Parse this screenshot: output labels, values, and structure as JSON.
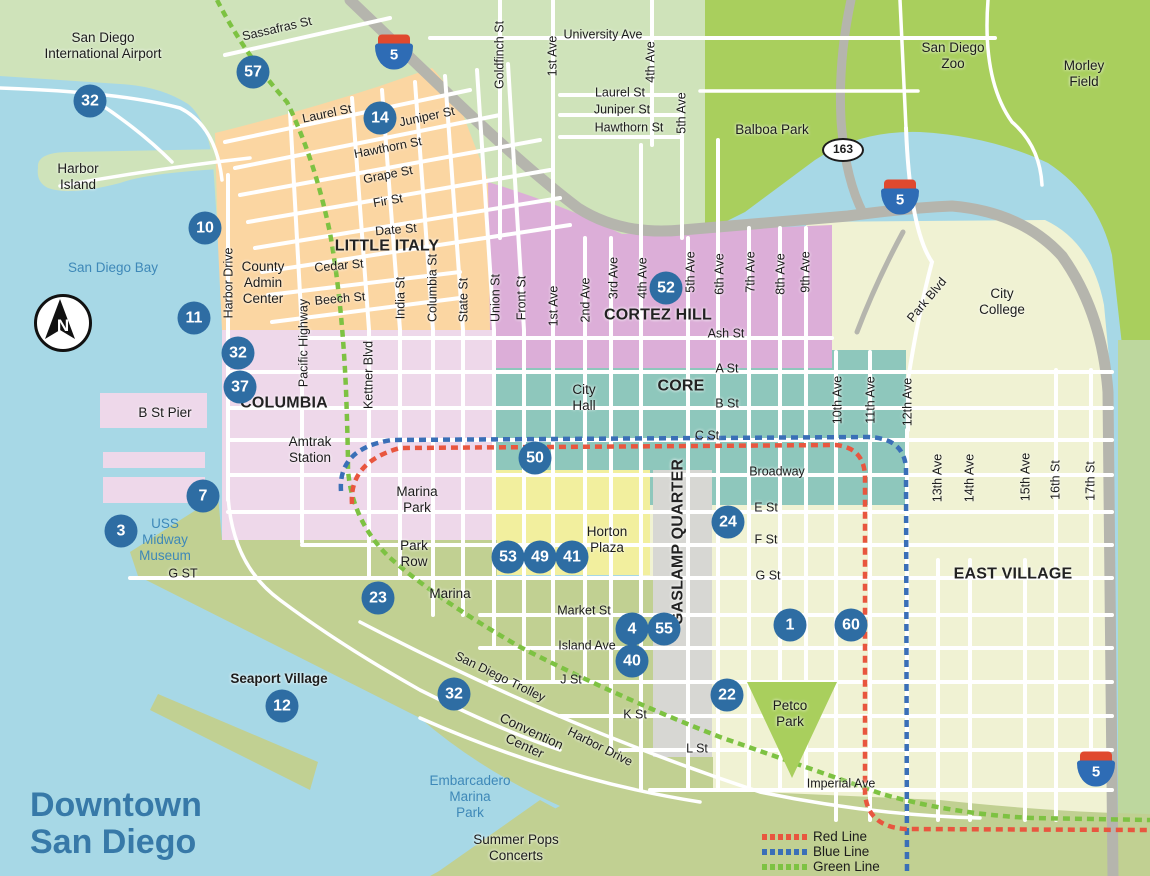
{
  "title": "Downtown\nSan Diego",
  "compass": {
    "label": "N"
  },
  "legend": [
    {
      "label": "Red Line",
      "color": "#e8563f"
    },
    {
      "label": "Blue Line",
      "color": "#3a6fb7"
    },
    {
      "label": "Green Line",
      "color": "#7dc242"
    }
  ],
  "colors": {
    "water": "#a7d8e6",
    "landPale": "#cfe3ba",
    "landBright": "#a9cf5d",
    "landMid": "#bdd79e",
    "olive": "#c1d092",
    "orange": "#fbd6a2",
    "cortez": "#dcaed8",
    "pinkLight": "#eed8ea",
    "teal": "#8ec7bc",
    "eastVillage": "#f0f2d3",
    "yellow": "#f2ef9e",
    "gray": "#d7d7d3",
    "freeway": "#b5b5ad",
    "marker": "#2e6da3",
    "redLine": "#e8563f",
    "blueLine": "#3a6fb7",
    "greenLine": "#7dc242",
    "waterText": "#3e88b8",
    "titleText": "#3779a8"
  },
  "shields": [
    {
      "k": "i",
      "t": "5",
      "x": 394,
      "y": 52
    },
    {
      "k": "i",
      "t": "5",
      "x": 900,
      "y": 197
    },
    {
      "k": "i",
      "t": "5",
      "x": 1096,
      "y": 769
    },
    {
      "k": "s",
      "t": "163",
      "x": 843,
      "y": 150
    }
  ],
  "markers": [
    {
      "n": "57",
      "x": 253,
      "y": 72
    },
    {
      "n": "32",
      "x": 90,
      "y": 101
    },
    {
      "n": "14",
      "x": 380,
      "y": 118
    },
    {
      "n": "10",
      "x": 205,
      "y": 228
    },
    {
      "n": "11",
      "x": 194,
      "y": 318
    },
    {
      "n": "32",
      "x": 238,
      "y": 353
    },
    {
      "n": "37",
      "x": 240,
      "y": 387
    },
    {
      "n": "52",
      "x": 666,
      "y": 288
    },
    {
      "n": "50",
      "x": 535,
      "y": 458
    },
    {
      "n": "7",
      "x": 203,
      "y": 496
    },
    {
      "n": "3",
      "x": 121,
      "y": 531
    },
    {
      "n": "53",
      "x": 508,
      "y": 557
    },
    {
      "n": "49",
      "x": 540,
      "y": 557
    },
    {
      "n": "41",
      "x": 572,
      "y": 557
    },
    {
      "n": "24",
      "x": 728,
      "y": 522
    },
    {
      "n": "23",
      "x": 378,
      "y": 598
    },
    {
      "n": "4",
      "x": 632,
      "y": 629
    },
    {
      "n": "55",
      "x": 664,
      "y": 629
    },
    {
      "n": "40",
      "x": 632,
      "y": 661
    },
    {
      "n": "1",
      "x": 790,
      "y": 625
    },
    {
      "n": "60",
      "x": 851,
      "y": 625
    },
    {
      "n": "22",
      "x": 727,
      "y": 695
    },
    {
      "n": "12",
      "x": 282,
      "y": 706
    },
    {
      "n": "32",
      "x": 454,
      "y": 694
    }
  ],
  "labels": [
    [
      "San Diego\nInternational Airport",
      103,
      46,
      "pl"
    ],
    [
      "Harbor\nIsland",
      78,
      177,
      "pl"
    ],
    [
      "San Diego Bay",
      113,
      268,
      "water"
    ],
    [
      "Sassafras St",
      277,
      29,
      "st",
      -13
    ],
    [
      "University Ave",
      603,
      35,
      "st"
    ],
    [
      "Goldfinch St",
      500,
      55,
      "st",
      -90
    ],
    [
      "1st Ave",
      553,
      56,
      "st",
      -90
    ],
    [
      "4th Ave",
      651,
      62,
      "st",
      -90
    ],
    [
      "5th Ave",
      682,
      113,
      "st",
      -90
    ],
    [
      "Laurel St",
      620,
      93,
      "st"
    ],
    [
      "Juniper St",
      622,
      110,
      "st"
    ],
    [
      "Hawthorn St",
      629,
      128,
      "st"
    ],
    [
      "Balboa Park",
      772,
      130,
      "pl"
    ],
    [
      "San Diego\nZoo",
      953,
      56,
      "pl"
    ],
    [
      "Morley\nField",
      1084,
      74,
      "pl"
    ],
    [
      "City\nCollege",
      1002,
      302,
      "pl"
    ],
    [
      "Park Blvd",
      927,
      300,
      "st",
      -50
    ],
    [
      "Laurel St",
      327,
      114,
      "st",
      -12
    ],
    [
      "Juniper St",
      427,
      117,
      "st",
      -12
    ],
    [
      "Hawthorn St",
      388,
      148,
      "st",
      -11
    ],
    [
      "Grape St",
      388,
      175,
      "st",
      -11
    ],
    [
      "Fir St",
      388,
      201,
      "st",
      -10
    ],
    [
      "Date St",
      396,
      230,
      "st",
      -5
    ],
    [
      "LITTLE ITALY",
      387,
      247,
      "area"
    ],
    [
      "Cedar St",
      339,
      266,
      "st",
      -5
    ],
    [
      "Beech St",
      340,
      299,
      "st",
      -5
    ],
    [
      "Harbor Drive",
      229,
      283,
      "st",
      -90
    ],
    [
      "County\nAdmin\nCenter",
      263,
      283,
      "pl"
    ],
    [
      "Pacific Highway",
      304,
      343,
      "st",
      -90
    ],
    [
      "Kettner Blvd",
      369,
      375,
      "st",
      -90
    ],
    [
      "India St",
      401,
      298,
      "st",
      -90
    ],
    [
      "Columbia St",
      433,
      288,
      "st",
      -90
    ],
    [
      "State St",
      464,
      300,
      "st",
      -90
    ],
    [
      "Union St",
      496,
      298,
      "st",
      -90
    ],
    [
      "Front St",
      522,
      298,
      "st",
      -90
    ],
    [
      "1st Ave",
      554,
      306,
      "st",
      -90
    ],
    [
      "2nd Ave",
      586,
      300,
      "st",
      -90
    ],
    [
      "3rd Ave",
      614,
      278,
      "st",
      -90
    ],
    [
      "4th Ave",
      643,
      278,
      "st",
      -90
    ],
    [
      "5th Ave",
      691,
      272,
      "st",
      -90
    ],
    [
      "6th Ave",
      720,
      274,
      "st",
      -90
    ],
    [
      "7th Ave",
      751,
      272,
      "st",
      -90
    ],
    [
      "8th Ave",
      781,
      274,
      "st",
      -90
    ],
    [
      "9th Ave",
      806,
      272,
      "st",
      -90
    ],
    [
      "10th Ave",
      838,
      400,
      "st",
      -90
    ],
    [
      "11th Ave",
      871,
      400,
      "st",
      -90
    ],
    [
      "12th Ave",
      908,
      402,
      "st",
      -90
    ],
    [
      "13th Ave",
      938,
      478,
      "st",
      -90
    ],
    [
      "14th Ave",
      970,
      478,
      "st",
      -90
    ],
    [
      "15th Ave",
      1026,
      477,
      "st",
      -90
    ],
    [
      "16th St",
      1056,
      480,
      "st",
      -90
    ],
    [
      "17th St",
      1091,
      481,
      "st",
      -90
    ],
    [
      "CORTEZ HILL",
      658,
      316,
      "area"
    ],
    [
      "Ash St",
      726,
      334,
      "st"
    ],
    [
      "A St",
      727,
      369,
      "st"
    ],
    [
      "CORE",
      681,
      387,
      "area"
    ],
    [
      "B St",
      727,
      404,
      "st"
    ],
    [
      "C St",
      707,
      436,
      "st"
    ],
    [
      "City\nHall",
      584,
      398,
      "pl"
    ],
    [
      "COLUMBIA",
      284,
      404,
      "area"
    ],
    [
      "B St Pier",
      165,
      413,
      "pl"
    ],
    [
      "Amtrak\nStation",
      310,
      450,
      "pl"
    ],
    [
      "Broadway",
      777,
      472,
      "st"
    ],
    [
      "Marina\nPark",
      417,
      500,
      "pl"
    ],
    [
      "E St",
      766,
      508,
      "st"
    ],
    [
      "F St",
      766,
      540,
      "st"
    ],
    [
      "Horton\nPlaza",
      607,
      540,
      "pl"
    ],
    [
      "GASLAMP QUARTER",
      679,
      542,
      "area",
      -90
    ],
    [
      "G St",
      768,
      576,
      "st"
    ],
    [
      "EAST VILLAGE",
      1013,
      575,
      "area"
    ],
    [
      "Park\nRow",
      414,
      554,
      "pl"
    ],
    [
      "G ST",
      183,
      574,
      "st"
    ],
    [
      "USS\nMidway\nMuseum",
      165,
      540,
      "water"
    ],
    [
      "Marina",
      450,
      594,
      "pl"
    ],
    [
      "Market St",
      584,
      611,
      "st"
    ],
    [
      "Island Ave",
      587,
      646,
      "st"
    ],
    [
      "J St",
      571,
      680,
      "st"
    ],
    [
      "Seaport Village",
      279,
      679,
      "bold"
    ],
    [
      "K St",
      635,
      715,
      "st"
    ],
    [
      "San Diego Trolley",
      500,
      677,
      "st",
      26
    ],
    [
      "Harbor Drive",
      600,
      747,
      "st",
      27
    ],
    [
      "Convention\nCenter",
      528,
      739,
      "pl",
      25
    ],
    [
      "L St",
      697,
      749,
      "st"
    ],
    [
      "Petco\nPark",
      790,
      714,
      "pl"
    ],
    [
      "Imperial Ave",
      841,
      784,
      "st"
    ],
    [
      "Embarcadero\nMarina\nPark",
      470,
      797,
      "water"
    ],
    [
      "Summer Pops\nConcerts",
      516,
      848,
      "pl"
    ]
  ]
}
